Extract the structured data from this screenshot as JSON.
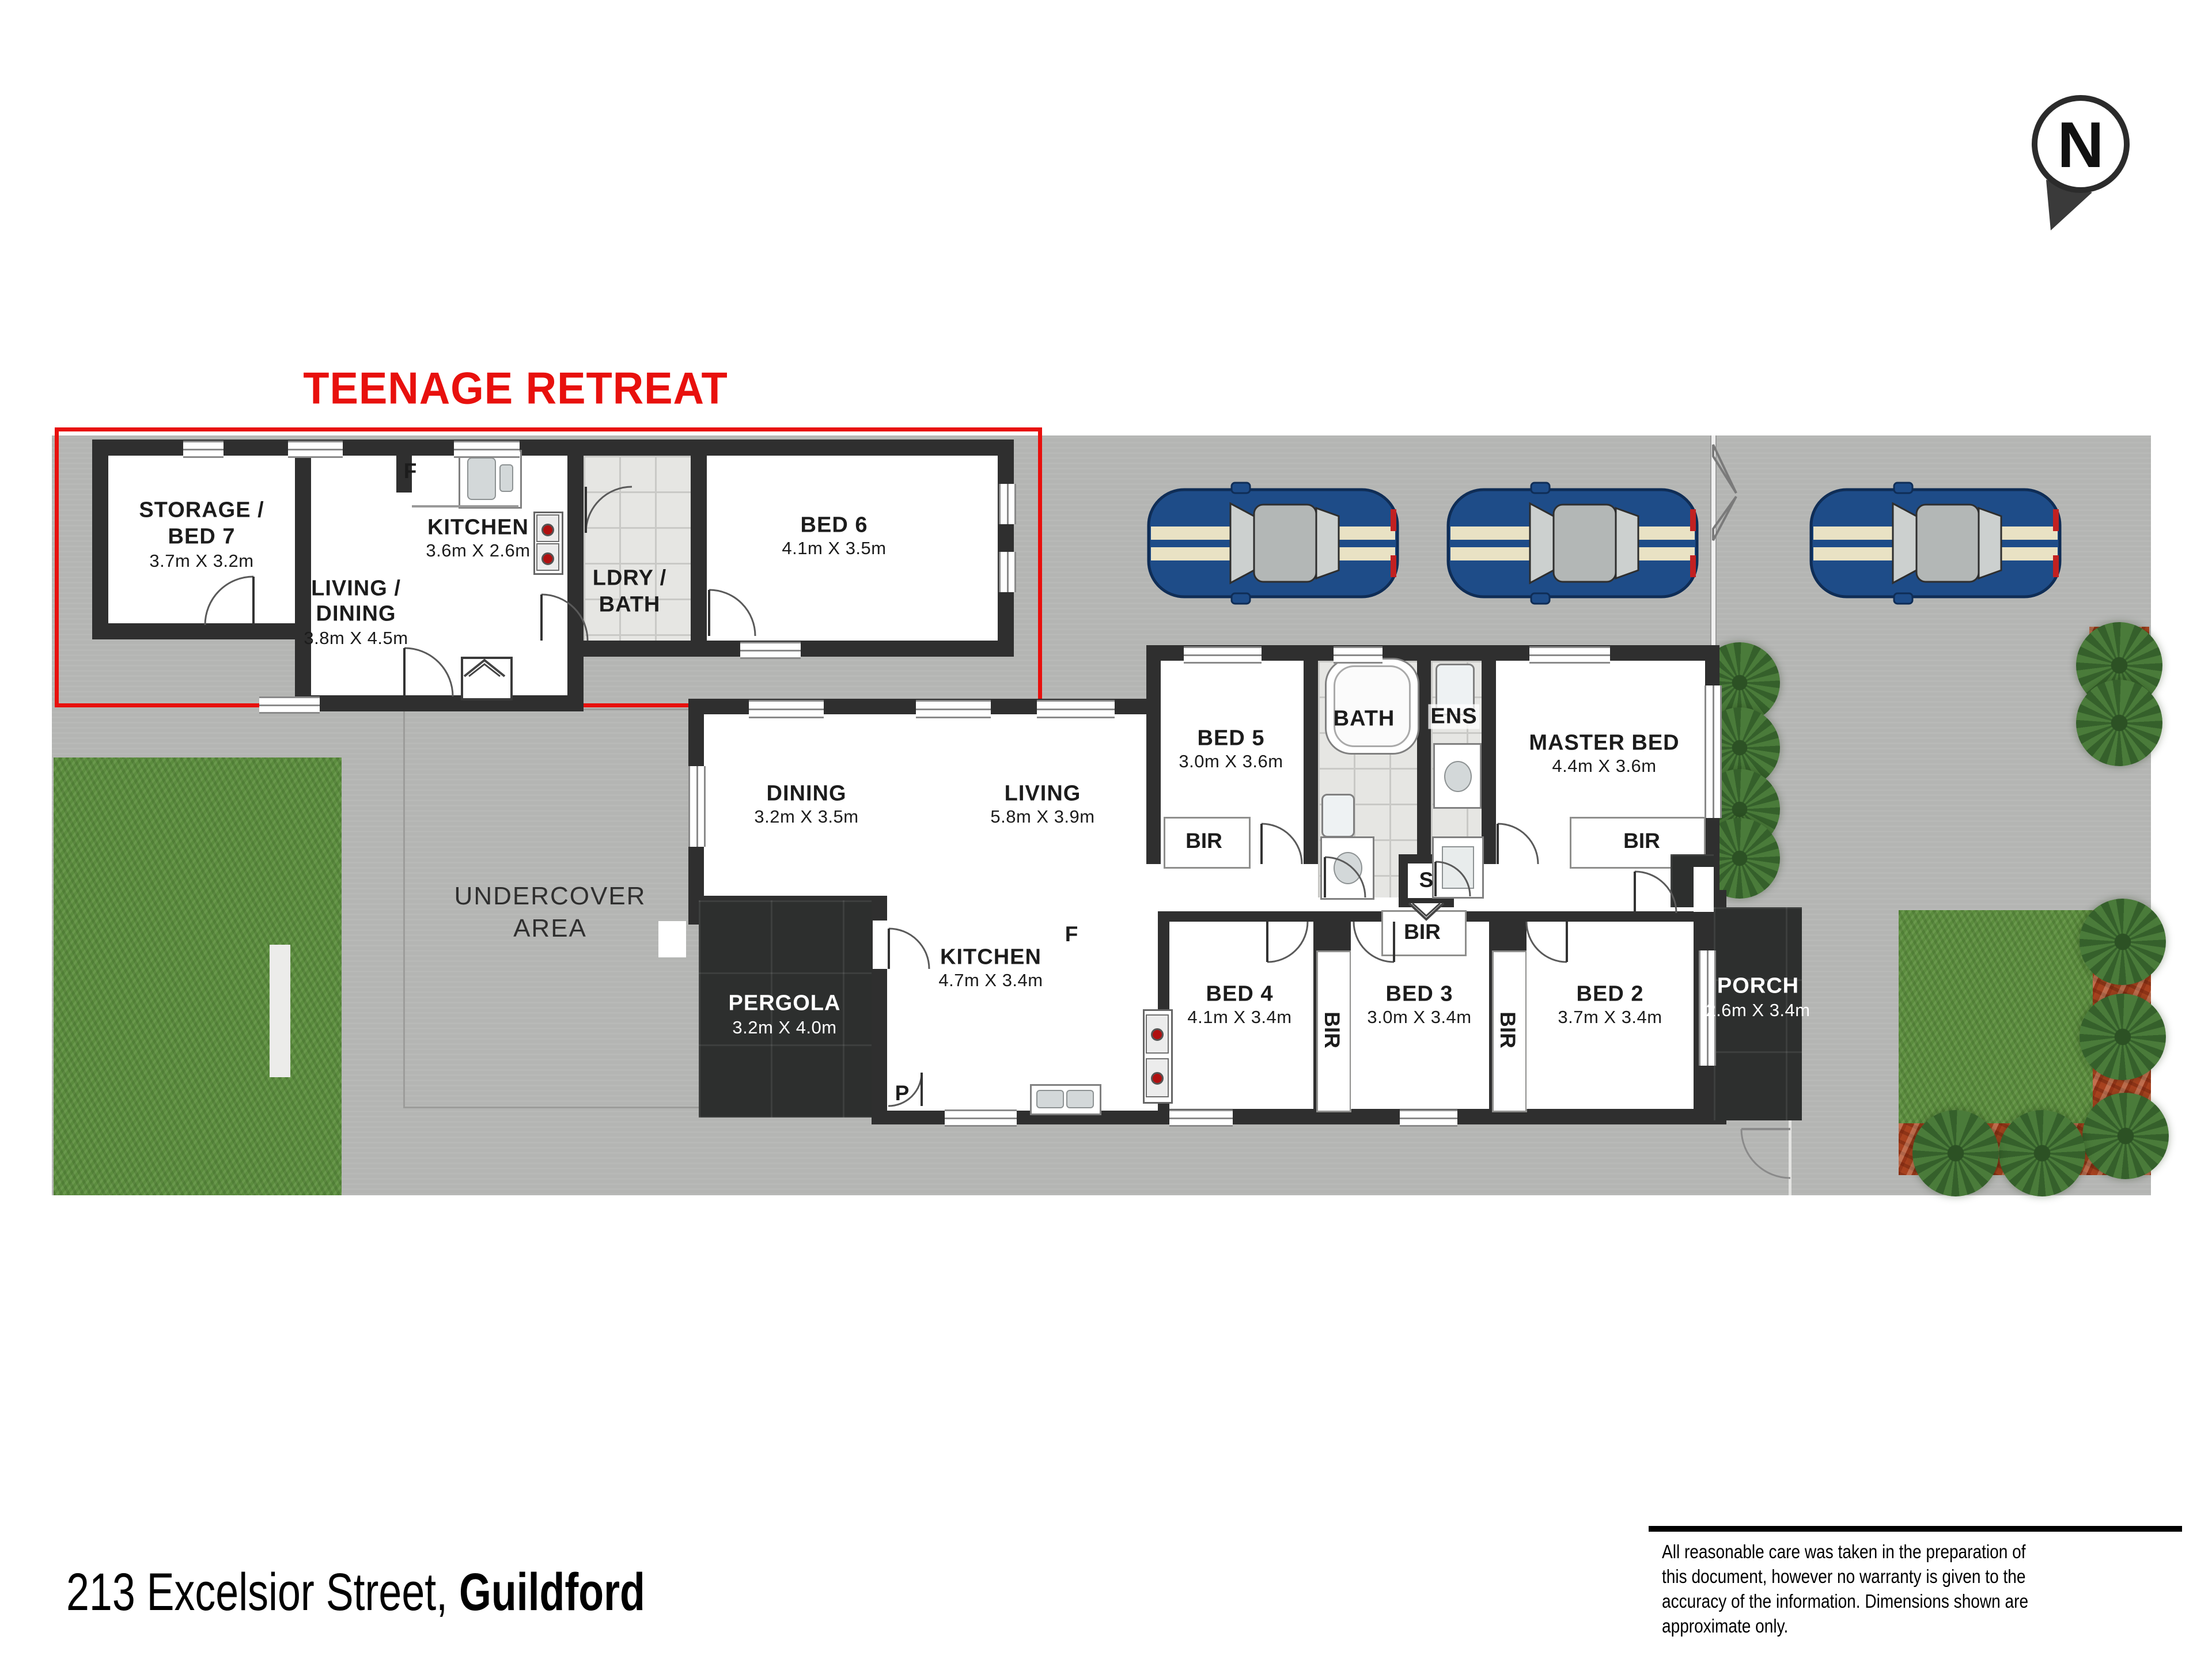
{
  "title": "TEENAGE RETREAT",
  "north_label": "N",
  "labels": {
    "bir": "BIR",
    "s": "S",
    "f": "F",
    "p": "P"
  },
  "retreat": {
    "storage": {
      "name1": "STORAGE /",
      "name2": "BED 7",
      "dims": "3.7m X 3.2m"
    },
    "kitchen": {
      "name": "KITCHEN",
      "dims": "3.6m X 2.6m"
    },
    "living": {
      "name1": "LIVING /",
      "name2": "DINING",
      "dims": "3.8m X 4.5m"
    },
    "ldry": {
      "name1": "LDRY /",
      "name2": "BATH"
    },
    "bed6": {
      "name": "BED 6",
      "dims": "4.1m X 3.5m"
    }
  },
  "house": {
    "dining": {
      "name": "DINING",
      "dims": "3.2m X 3.5m"
    },
    "living": {
      "name": "LIVING",
      "dims": "5.8m X 3.9m"
    },
    "bed5": {
      "name": "BED 5",
      "dims": "3.0m X 3.6m"
    },
    "bath": {
      "name": "BATH"
    },
    "ens": {
      "name": "ENS"
    },
    "master": {
      "name": "MASTER BED",
      "dims": "4.4m X 3.6m"
    },
    "kitchen": {
      "name": "KITCHEN",
      "dims": "4.7m X 3.4m"
    },
    "bed4": {
      "name": "BED 4",
      "dims": "4.1m X 3.4m"
    },
    "bed3": {
      "name": "BED 3",
      "dims": "3.0m X 3.4m"
    },
    "bed2": {
      "name": "BED 2",
      "dims": "3.7m X 3.4m"
    },
    "porch": {
      "name": "PORCH",
      "dims": "2.6m X 3.4m"
    },
    "pergola": {
      "name": "PERGOLA",
      "dims": "3.2m X 4.0m"
    },
    "undercover": {
      "line1": "UNDERCOVER",
      "line2": "AREA"
    }
  },
  "address": {
    "prefix": "213 Excelsior Street, ",
    "bold": "Guildford"
  },
  "disclaimer": {
    "line1": "All reasonable care was taken in the preparation of",
    "line2": "this document, however no warranty is given to the",
    "line3": "accuracy of the information. Dimensions shown are",
    "line4": "approximate only."
  },
  "colors": {
    "accent_red": "#e8100d",
    "wall": "#2f2f2f",
    "driveway": "#b4b5b3",
    "grass": "#5b8c3e",
    "mulch": "#a8421f",
    "car_blue": "#1e4c88",
    "car_stripe": "#e9e2c4"
  }
}
